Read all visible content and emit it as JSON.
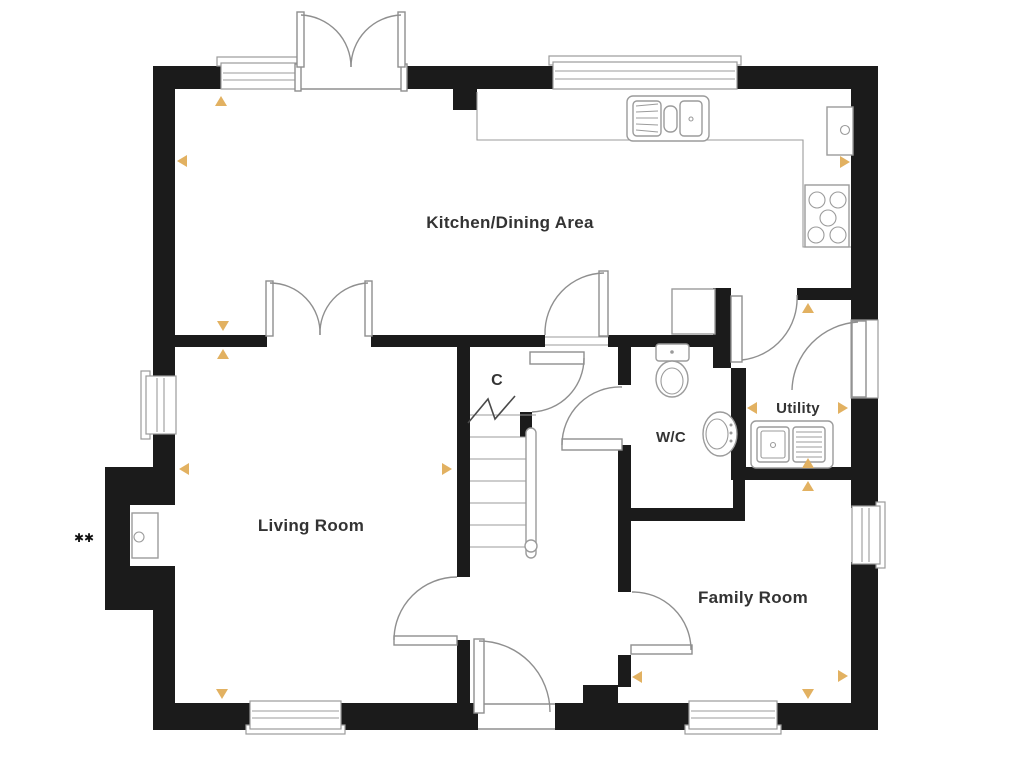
{
  "plan": {
    "colors": {
      "wall": "#1b1b1b",
      "line": "#8f8f8f",
      "fixture_line": "#9b9b9b",
      "marker": "#e2b161",
      "text": "#333333",
      "background": "#ffffff"
    },
    "rooms": [
      {
        "id": "kitchen-dining",
        "label": "Kitchen/Dining Area",
        "x": 510,
        "y": 228,
        "size": 17
      },
      {
        "id": "living-room",
        "label": "Living Room",
        "x": 311,
        "y": 531,
        "size": 17
      },
      {
        "id": "family-room",
        "label": "Family Room",
        "x": 753,
        "y": 603,
        "size": 17
      },
      {
        "id": "wc",
        "label": "W/C",
        "x": 671,
        "y": 442,
        "size": 15
      },
      {
        "id": "utility",
        "label": "Utility",
        "x": 798,
        "y": 413,
        "size": 15
      },
      {
        "id": "cupboard",
        "label": "C",
        "x": 497,
        "y": 385,
        "size": 16
      }
    ],
    "annotation": {
      "text": "✱✱",
      "x": 84,
      "y": 542,
      "size": 12
    },
    "markers": [
      {
        "dir": "up",
        "x": 221,
        "y": 101
      },
      {
        "dir": "left",
        "x": 182,
        "y": 161
      },
      {
        "dir": "down",
        "x": 223,
        "y": 326
      },
      {
        "dir": "up",
        "x": 223,
        "y": 354
      },
      {
        "dir": "left",
        "x": 184,
        "y": 469
      },
      {
        "dir": "right",
        "x": 447,
        "y": 469
      },
      {
        "dir": "right",
        "x": 845,
        "y": 162
      },
      {
        "dir": "up",
        "x": 808,
        "y": 308
      },
      {
        "dir": "left",
        "x": 752,
        "y": 408
      },
      {
        "dir": "right",
        "x": 843,
        "y": 408
      },
      {
        "dir": "up",
        "x": 808,
        "y": 463
      },
      {
        "dir": "up",
        "x": 808,
        "y": 486
      },
      {
        "dir": "left",
        "x": 637,
        "y": 677
      },
      {
        "dir": "right",
        "x": 843,
        "y": 676
      },
      {
        "dir": "down",
        "x": 808,
        "y": 694
      },
      {
        "dir": "down",
        "x": 222,
        "y": 694
      }
    ],
    "fixtures": [
      "kitchen-counter",
      "kitchen-sink",
      "boiler-unit",
      "hob",
      "wall-cupboard",
      "toilet",
      "wash-basin",
      "utility-sink",
      "staircase",
      "fireplace-recess"
    ]
  }
}
